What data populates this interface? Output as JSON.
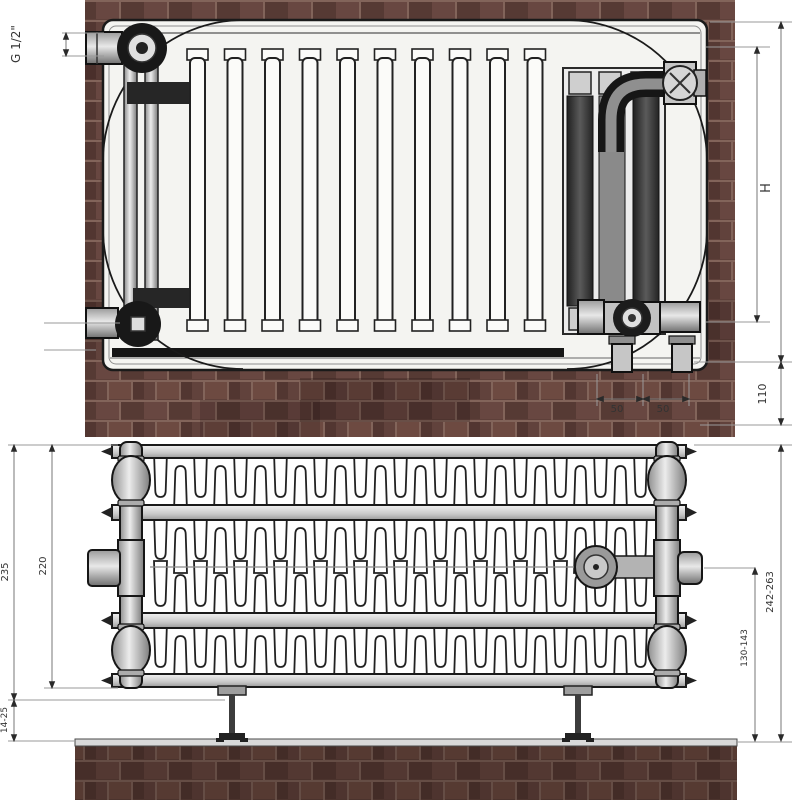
{
  "labels": {
    "front_view": {
      "thread_size": "G 1/2\"",
      "height": "H",
      "bottom_clearance": "110",
      "pipe_spacing_a": "50",
      "pipe_spacing_b": "50"
    },
    "top_view": {
      "depth_inner": "220",
      "depth_outer": "235",
      "floor_gap": "14-25",
      "wall_distance_total": "242-263",
      "pipe_axis_distance": "130-143"
    }
  },
  "colors": {
    "brick": "#5e403a",
    "brick_dark": "#47302c",
    "mortar": "#82645a",
    "outline": "#1a1a1a",
    "metal_light": "#d9d9d9",
    "panel_white": "#f4f4f1",
    "dimension_line": "#8a8a8a",
    "valve_dark": "#2e2e2e"
  }
}
